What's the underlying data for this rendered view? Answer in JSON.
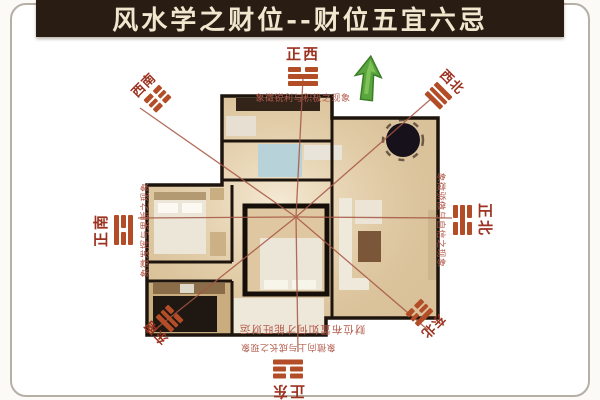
{
  "title": "风水学之财位--财位五宜六忌",
  "directions": {
    "west": {
      "label": "正西",
      "pattern": [
        "broken",
        "solid",
        "solid"
      ],
      "caption": "象徵锐利与积极之现象"
    },
    "south": {
      "label": "正南",
      "pattern": [
        "solid",
        "broken",
        "solid"
      ],
      "caption": "象徵发挥与果断之现象"
    },
    "north": {
      "label": "正北",
      "pattern": [
        "broken",
        "solid",
        "broken"
      ],
      "caption": "象徵骄傲与自信之现象"
    },
    "east": {
      "label": "正东",
      "pattern": [
        "broken",
        "broken",
        "solid"
      ],
      "caption": "象徵向上与成长之现象"
    },
    "southwest": {
      "label": "西南",
      "pattern": [
        "broken",
        "broken",
        "broken"
      ]
    },
    "northwest": {
      "label": "西北",
      "pattern": [
        "solid",
        "solid",
        "solid"
      ]
    },
    "southeast": {
      "label": "东南",
      "pattern": [
        "solid",
        "solid",
        "broken"
      ]
    },
    "northeast": {
      "label": "东北",
      "pattern": [
        "solid",
        "broken",
        "broken"
      ]
    }
  },
  "plan_note": "财位布置如何才能旺财运",
  "icons": {
    "direction_arrow": "green-up-arrow"
  },
  "colors": {
    "title_bg": "#281c13",
    "title_text": "#f1e6ce",
    "label_red": "#9c3220",
    "trigram_red": "#b34d28",
    "caption_red": "#b3594a",
    "bagua_line": "#a65543",
    "arrow_green": "#5aa63e",
    "floor_beige": "#d9c199",
    "wall_dark": "#1d140d",
    "frame_gray": "#b5b0a6"
  }
}
